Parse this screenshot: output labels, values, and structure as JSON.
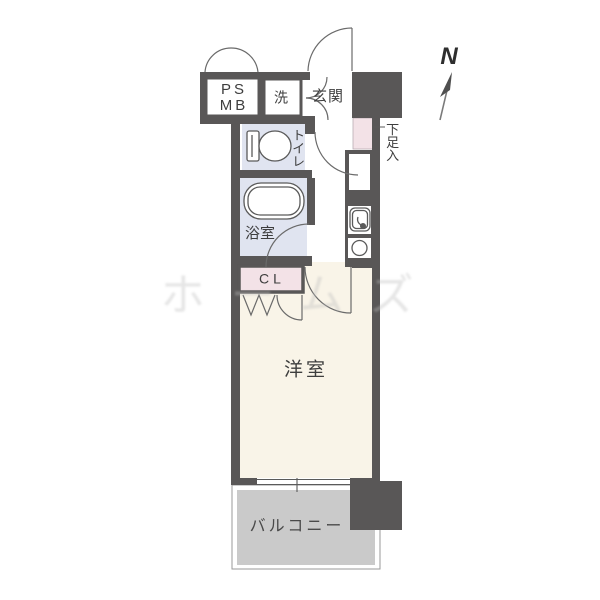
{
  "plan": {
    "rooms": {
      "ps_mb": {
        "line1": "PS",
        "line2": "MB"
      },
      "laundry": {
        "label": "洗"
      },
      "entrance": {
        "label": "玄関"
      },
      "shoe_cabinet": {
        "label": "下足入"
      },
      "toilet": {
        "label": "トイレ"
      },
      "bathroom": {
        "label": "浴室"
      },
      "closet": {
        "label": "CL"
      },
      "western_room": {
        "label": "洋室"
      },
      "balcony": {
        "label": "バルコニー"
      }
    },
    "compass": {
      "label": "N"
    },
    "watermark": {
      "text": "ホームズ"
    },
    "colors": {
      "wall": "#595757",
      "wet_area_floor": "#e0e4f0",
      "closet_floor": "#f3e2e7",
      "room_floor": "#f9f4e8",
      "balcony_floor": "#cacaca"
    }
  }
}
